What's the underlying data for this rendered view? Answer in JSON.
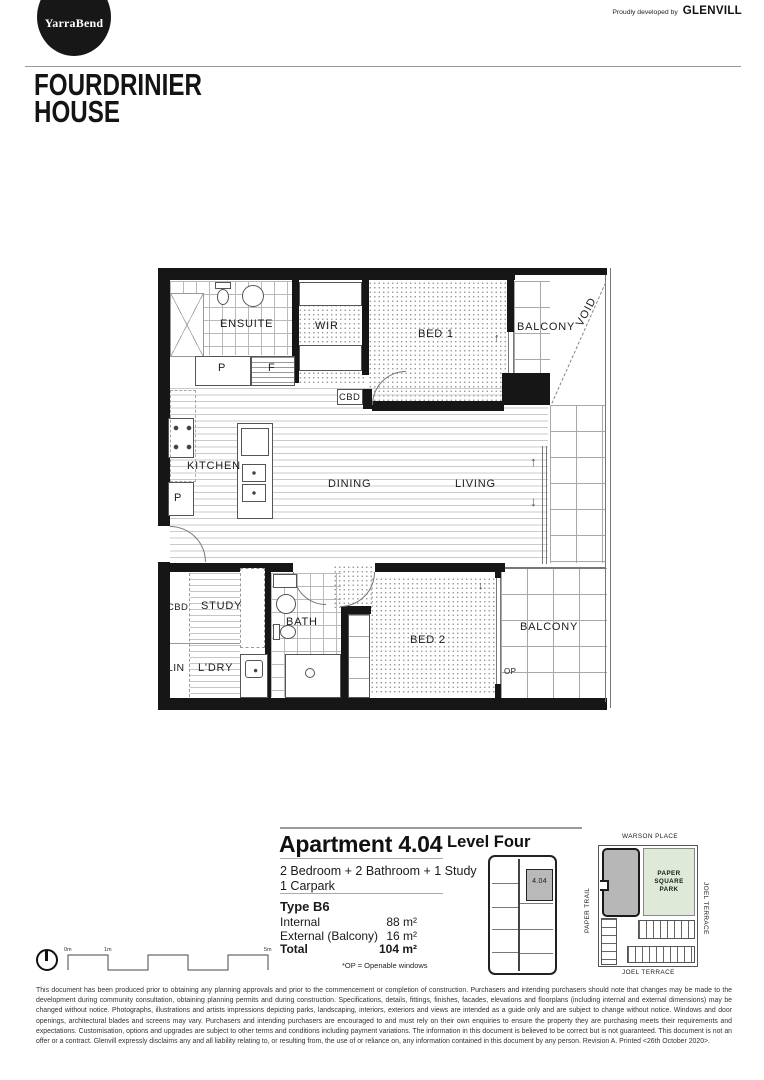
{
  "header": {
    "logo": "YarraBend",
    "developed_by_prefix": "Proudly developed by",
    "developer": "GLENVILL",
    "building_line1": "FOURDRINIER",
    "building_line2": "HOUSE"
  },
  "plan": {
    "labels": {
      "ensuite": "ENSUITE",
      "wir": "WIR",
      "bed1": "BED 1",
      "balcony_top": "BALCONY",
      "void": "VOID",
      "cbd_hall": "CBD",
      "p_joinery": "P",
      "f_fridge": "F",
      "kitchen": "KITCHEN",
      "p_pantry": "P",
      "dining": "DINING",
      "living": "LIVING",
      "cbd_study": "CBD",
      "study": "STUDY",
      "lin": "LIN",
      "ldry": "L'DRY",
      "bath": "BATH",
      "bed2": "BED 2",
      "balcony_bottom": "BALCONY",
      "op": "OP"
    },
    "icons": {
      "up": "↑",
      "down": "↓"
    }
  },
  "details": {
    "title": "Apartment 4.04",
    "config_line1": "2 Bedroom + 2 Bathroom + 1 Study",
    "config_line2": "1 Carpark",
    "type": "Type B6",
    "areas": [
      {
        "label": "Internal",
        "value": "88 m²"
      },
      {
        "label": "External (Balcony)",
        "value": "16 m²"
      },
      {
        "label": "Total",
        "value": "104 m²"
      }
    ],
    "footnote": "*OP = Openable windows"
  },
  "level_key": {
    "title": "Level Four",
    "unit": "4.04"
  },
  "site_map": {
    "street_top": "WARSON PLACE",
    "street_left": "PAPER TRAIL",
    "street_right": "JOEL TERRACE",
    "street_bottom": "JOEL TERRACE",
    "park": "PAPER SQUARE PARK"
  },
  "scale_bar": {
    "start": "0m",
    "first": "1m",
    "end": "5m"
  },
  "disclaimer": "This document has been produced prior to obtaining any planning approvals and prior to the commencement or completion of construction. Purchasers and intending purchasers should note that changes may be made to the development during community consultation, obtaining planning permits and during construction. Specifications, details, fittings, finishes, facades, elevations and floorplans (including internal and external dimensions) may be changed without notice. Photographs, illustrations and artists impressions depicting parks, landscaping, interiors, exteriors and views are intended as a guide only and are subject to change without notice. Windows and door openings, architectural blades and screens may vary. Purchasers and intending purchasers are encouraged to and must rely on their own enquiries to ensure the property they are purchasing meets their requirements and expectations. Customisation, options and upgrades are subject to other terms and conditions including payment variations. The information in this document is believed to be correct but is not guaranteed. This document is not an offer or a contract. Glenvill expressly disclaims any and all liability relating to, or resulting from, the use of or reliance on, any information contained in this document by any person. Revision A. Printed <26th October 2020>."
}
